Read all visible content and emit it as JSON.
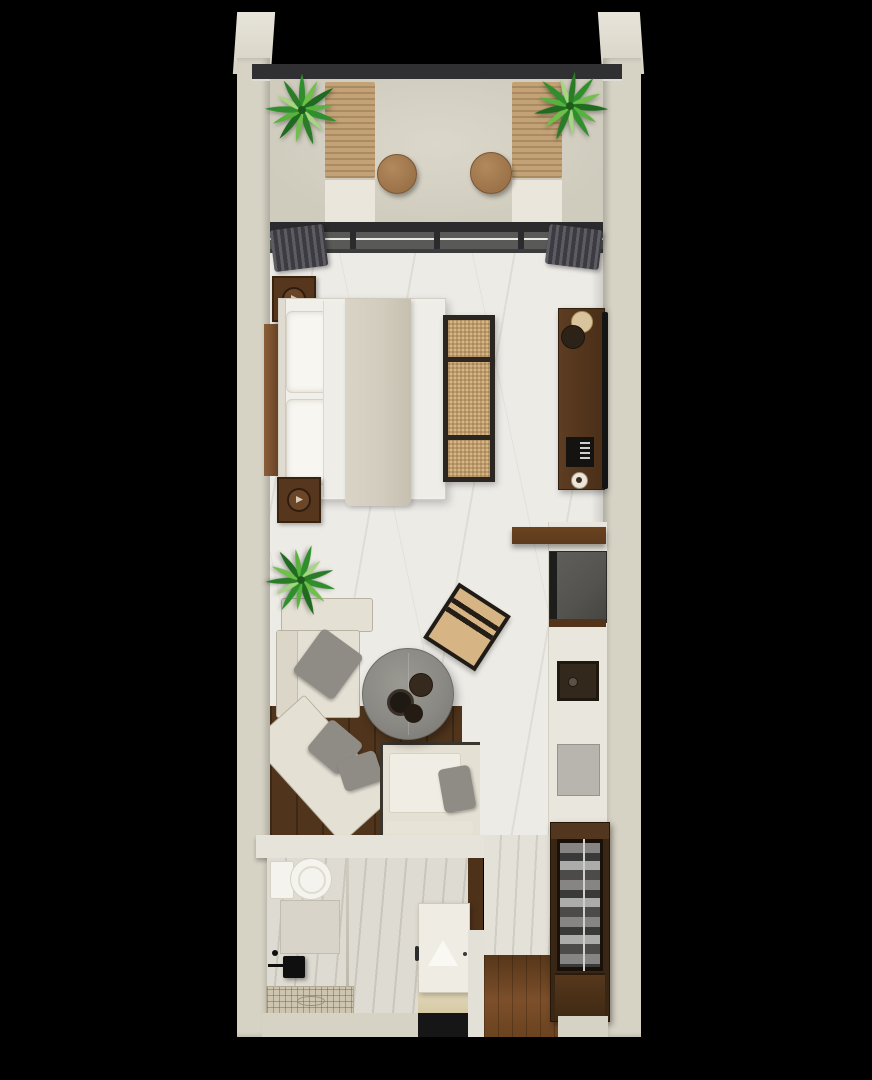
{
  "scene": {
    "title": "Studio apartment floor plan 3D render",
    "view": "top-down",
    "rooms": [
      {
        "name": "balcony",
        "items": [
          "planter-left",
          "planter-right",
          "sun-lounger-left",
          "sun-lounger-right",
          "round-side-table-left",
          "round-side-table-right",
          "glass-railing",
          "sliding-glass-door",
          "curtain-left",
          "curtain-right"
        ]
      },
      {
        "name": "bedroom",
        "items": [
          "double-bed",
          "pillow-upper",
          "pillow-lower",
          "bed-runner",
          "headboard-panel",
          "nightstand-upper",
          "nightstand-lower",
          "cane-bench",
          "media-console",
          "console-tray",
          "coffee-machine",
          "cup",
          "wall-mounted-tv"
        ]
      },
      {
        "name": "living-area",
        "items": [
          "corner-sofa",
          "sofa-chaise",
          "sofa-throw-pillows",
          "round-concrete-coffee-table",
          "table-tray-set",
          "cane-accent-chair",
          "floor-plant",
          "dark-wood-area-rug"
        ]
      },
      {
        "name": "kitchenette",
        "items": [
          "wall-shelf",
          "minibar-appliance",
          "sink",
          "induction-mat",
          "white-counter"
        ]
      },
      {
        "name": "bathroom",
        "items": [
          "toilet",
          "vanity-block",
          "glass-partition",
          "shower-head",
          "shower-arm",
          "shower-tray",
          "bathroom-door",
          "door-handle"
        ]
      },
      {
        "name": "entry",
        "items": [
          "open-wardrobe",
          "hanging-clothes",
          "wardrobe-rail",
          "shoe-cabinet",
          "wood-floor",
          "entry-mat"
        ]
      }
    ],
    "palette": {
      "background": "#000000",
      "wall": "#d6d2c4",
      "wallCap": "#e7e4da",
      "railing": "#303032",
      "balconyFloor": "#cfcbbd",
      "loungerWood": "#c3a277",
      "loungerCushion": "#eae6db",
      "tableWood": "#9c7349",
      "plantGreen": "#2f8f2c",
      "plantLight": "#6fbf4a",
      "plantDark": "#1f6b1f",
      "doorFrame": "#2b2b2d",
      "curtainDark": "#3b3b41",
      "curtainLight": "#5c5c62",
      "marble": "#edebe6",
      "marbleBath": "#dedbd2",
      "woodDark": "#57361e",
      "woodShelf": "#5d3a1e",
      "woodPlatform": "#50351c",
      "woodFloorEntry": "#7c4f2a",
      "bedWhite": "#f1efe9",
      "runner": "#d2ccbe",
      "cane": "#d6b483",
      "caneFrame": "#2b2620",
      "sofaCream": "#e5e0d4",
      "pillowGray": "#8f8c85",
      "concreteTable": "#8a8984",
      "tvBlack": "#141414",
      "applianceGray": "#54534f",
      "fixtureBlack": "#0f0f0f",
      "matBlack": "#161616",
      "showerTile": "#cdc5b0",
      "porcelain": "#f5f3ee"
    }
  }
}
